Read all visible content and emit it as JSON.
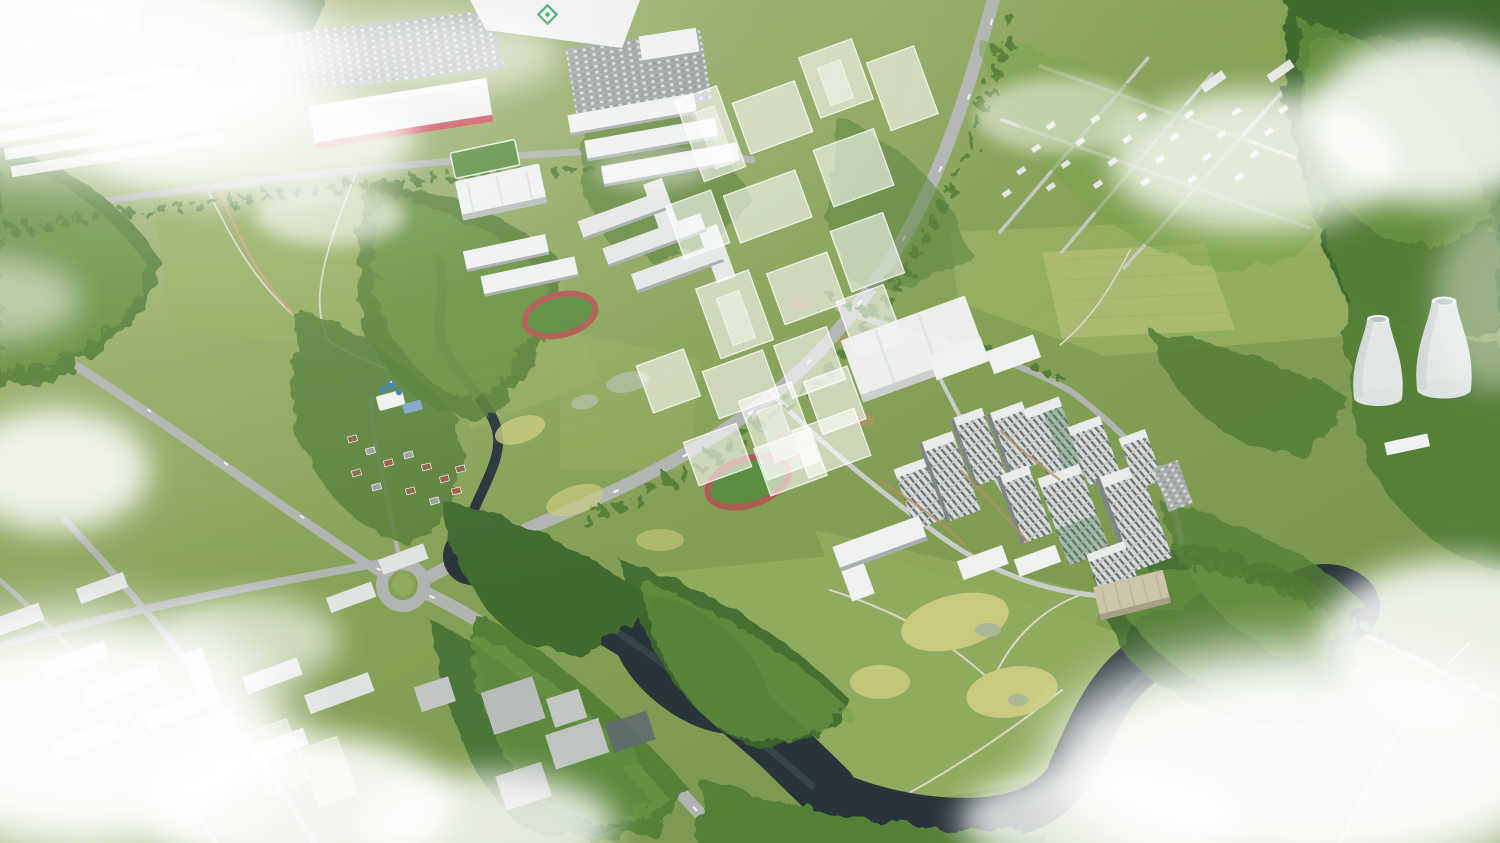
{
  "meta": {
    "type": "aerial-architectural-render",
    "description": "Bird's-eye architectural rendering of a riverside residential masterplan: an oxbow river loop around a green peninsula, a cluster of high-rise towers, translucent planned buildings, retail warehouses, a park with running tracks, a village with a blue-roofed church, two cooling towers at right, and drifting clouds",
    "width": 1500,
    "height": 843
  },
  "palette": {
    "grassHaze": "#a8b97c",
    "grassBase": "#86a257",
    "grassDeep": "#75924a",
    "grassLight": "#93ad60",
    "grassPale": "#aebc74",
    "lawn": "#8fab5d",
    "meadowYellow": "#c9ca7d",
    "forestDark": "#3f6a2e",
    "forestMid": "#567f38",
    "forestLight": "#79a24c",
    "river": "#273439",
    "riverLight": "#45585e",
    "road": "#b0b5b2",
    "roadLight": "#c9cdca",
    "roadDark": "#9aa09d",
    "trail": "#d9d6c4",
    "dirt": "#c0a578",
    "buildingWhite": "#f0f2f1",
    "buildingSide": "#a7adac",
    "roof": "#e9eceb",
    "facadeLight": "#d9dddc",
    "facadeDark": "#6d7776",
    "facadeGreen": "#5d7a68",
    "beige": "#cdc4a9",
    "signRed": "#c43b44",
    "logoGreen": "#2f9e63",
    "churchBlue": "#3d7fb0",
    "pond": "#aab896",
    "pitch": "#5a8d3f",
    "track": "#b05a50",
    "cloud": "#ffffff"
  },
  "scene": {
    "landmarks": [
      {
        "name": "retail-warehouse-zone",
        "note": "white big-box stores and parking lots, top left"
      },
      {
        "name": "big-box-store-sign",
        "color": "#c43b44",
        "legible": false
      },
      {
        "name": "green-diamond-roof-logo",
        "color": "#2f9e63"
      },
      {
        "name": "planned-ghost-buildings",
        "note": "translucent white massing blocks"
      },
      {
        "name": "main-residential-complex",
        "note": "opaque high-rise towers, center right"
      },
      {
        "name": "running-tracks",
        "count": 2
      },
      {
        "name": "village-with-church",
        "note": "blue-roofed church and cottages"
      },
      {
        "name": "oxbow-river-loop"
      },
      {
        "name": "peninsula-meadow"
      },
      {
        "name": "cooling-towers",
        "count": 2
      },
      {
        "name": "suburb-grid",
        "note": "low-rise houses in trees, top right"
      },
      {
        "name": "open-field",
        "note": "large mown field, right"
      },
      {
        "name": "city-blocks",
        "note": "mid-rise slabs under clouds, bottom left"
      },
      {
        "name": "clouds"
      }
    ]
  }
}
